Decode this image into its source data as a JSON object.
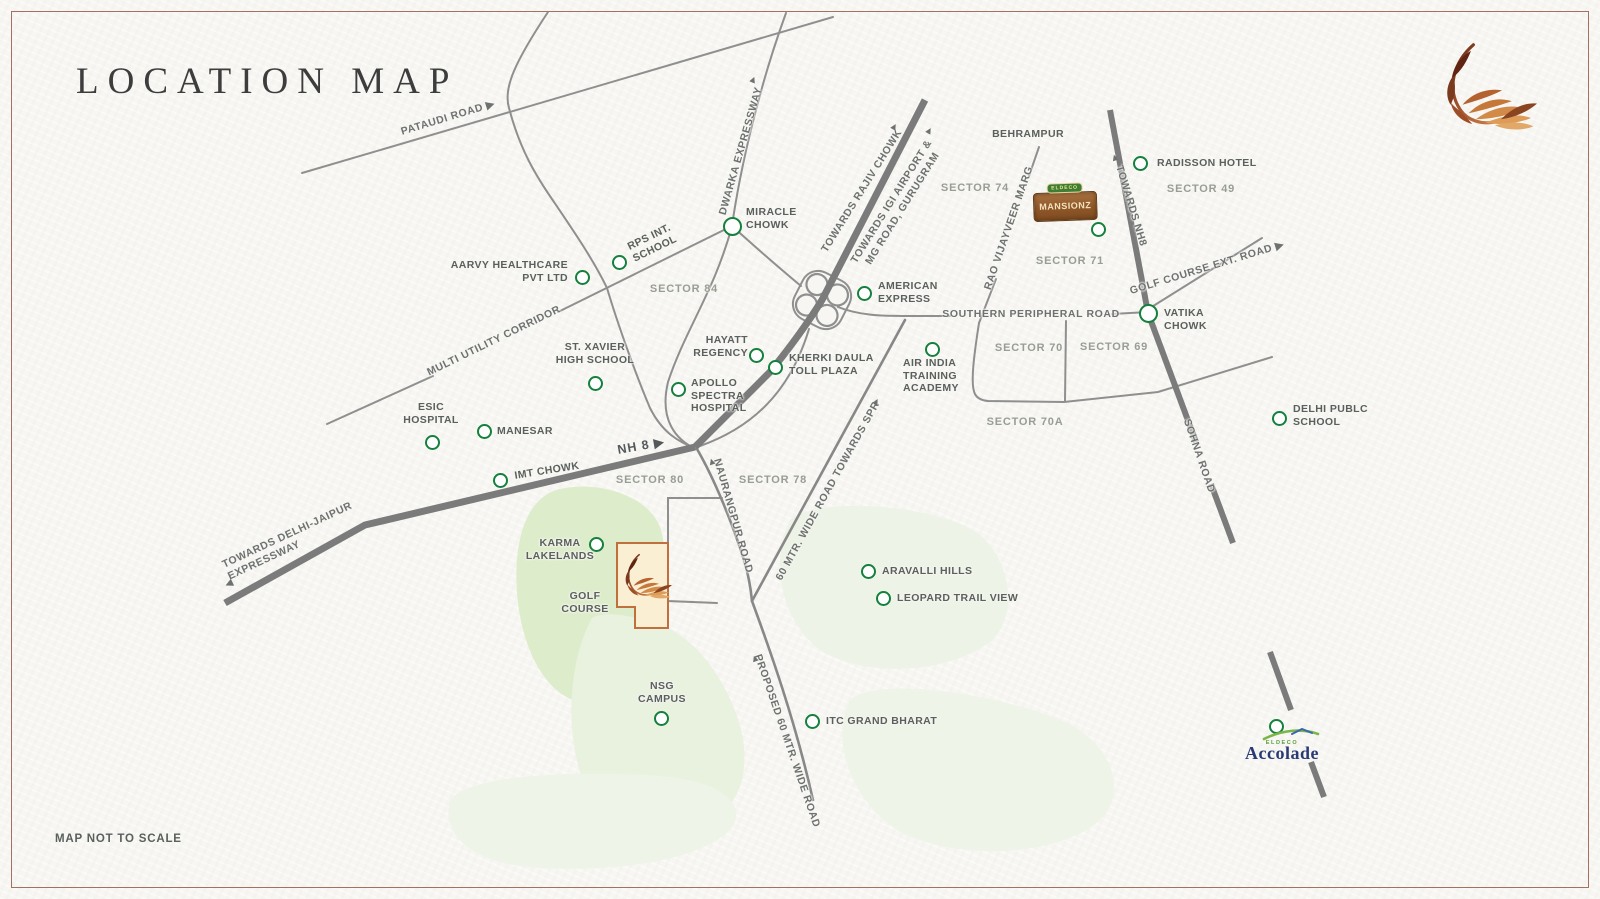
{
  "page": {
    "title": "LOCATION MAP",
    "disclaimer": "MAP NOT TO SCALE"
  },
  "colors": {
    "background": "#f7f6f2",
    "frame_border": "#a4705f",
    "road_thin": "#8f8f8f",
    "road_thick": "#7b7b7b",
    "marker_green": "#15803d",
    "label_dark": "#5a605d",
    "label_sector": "#989d95",
    "golf_green": "#ddecca",
    "pale_green": "#edf3e6",
    "site_fill": "#faeed3",
    "site_border": "#c0703c",
    "feather_copper": "#b4622f",
    "accolade_navy": "#2a3a75",
    "eldeco_green": "#3e7d35"
  },
  "logos": {
    "brand_icon": "feather-icon",
    "mansionz": {
      "badge": "ELDECO",
      "name": "MANSIONZ"
    },
    "accolade": {
      "badge": "ELDECO",
      "name": "Accolade"
    }
  },
  "map": {
    "markers": [
      {
        "id": "miracle-chowk",
        "cx": 732,
        "cy": 226,
        "r": 9.5,
        "lines": [
          "MIRACLE",
          "CHOWK"
        ],
        "anchor": "left",
        "lx": 746,
        "ly": 206
      },
      {
        "id": "rps-int-school",
        "cx": 619,
        "cy": 262,
        "lines": [
          "RPS INT.",
          "SCHOOL"
        ],
        "rot": -26,
        "lx": 652,
        "ly": 243
      },
      {
        "id": "aarvy-healthcare",
        "cx": 582,
        "cy": 277,
        "lines": [
          "AARVY HEALTHCARE",
          "PVT LTD"
        ],
        "anchor": "right",
        "lx": 568,
        "ly": 259
      },
      {
        "id": "american-express",
        "cx": 864,
        "cy": 293,
        "lines": [
          "AMERICAN",
          "EXPRESS"
        ],
        "anchor": "left",
        "lx": 878,
        "ly": 280
      },
      {
        "id": "radisson-hotel",
        "cx": 1140,
        "cy": 163,
        "lines": [
          "RADISSON HOTEL"
        ],
        "anchor": "left",
        "lx": 1157,
        "ly": 157
      },
      {
        "id": "behrampur",
        "lines": [
          "BEHRAMPUR"
        ],
        "anchor": "center",
        "lx": 1028,
        "ly": 128
      },
      {
        "id": "mansionz-site",
        "cx": 1098,
        "cy": 229
      },
      {
        "id": "vatika-chowk",
        "cx": 1148,
        "cy": 313,
        "r": 9.5,
        "lines": [
          "VATIKA",
          "CHOWK"
        ],
        "anchor": "left",
        "lx": 1164,
        "ly": 307
      },
      {
        "id": "hayatt-regency",
        "cx": 756,
        "cy": 355,
        "lines": [
          "HAYATT",
          "REGENCY"
        ],
        "anchor": "right",
        "lx": 748,
        "ly": 334
      },
      {
        "id": "kherki-daula-toll-plaza",
        "cx": 775,
        "cy": 367,
        "lines": [
          "KHERKI DAULA",
          "TOLL PLAZA"
        ],
        "anchor": "left",
        "lx": 789,
        "ly": 352
      },
      {
        "id": "apollo-spectra-hospital",
        "cx": 678,
        "cy": 389,
        "lines": [
          "APOLLO",
          "SPECTRA",
          "HOSPITAL"
        ],
        "anchor": "left",
        "lx": 691,
        "ly": 377
      },
      {
        "id": "st-xavier-high-school",
        "cx": 595,
        "cy": 383,
        "lines": [
          "ST. XAVIER",
          "HIGH SCHOOL"
        ],
        "anchor": "center",
        "lx": 595,
        "ly": 341
      },
      {
        "id": "air-india-training-academy",
        "cx": 932,
        "cy": 349,
        "lines": [
          "AIR INDIA",
          "TRAINING",
          "ACADEMY"
        ],
        "anchor": "left",
        "lx": 903,
        "ly": 357
      },
      {
        "id": "esic-hospital",
        "cx": 432,
        "cy": 442,
        "lines": [
          "ESIC",
          "HOSPITAL"
        ],
        "anchor": "center",
        "lx": 431,
        "ly": 401
      },
      {
        "id": "manesar",
        "cx": 484,
        "cy": 431,
        "lines": [
          "MANESAR"
        ],
        "anchor": "left",
        "lx": 497,
        "ly": 425
      },
      {
        "id": "imt-chowk",
        "cx": 500,
        "cy": 480,
        "lines": [
          "IMT CHOWK"
        ],
        "rot": -9,
        "lx": 547,
        "ly": 471
      },
      {
        "id": "karma-lakelands",
        "cx": 596,
        "cy": 544,
        "lines": [
          "KARMA",
          "LAKELANDS"
        ],
        "anchor": "center",
        "lx": 560,
        "ly": 537
      },
      {
        "id": "golf-course",
        "lines": [
          "GOLF",
          "COURSE"
        ],
        "anchor": "center",
        "lx": 585,
        "ly": 590
      },
      {
        "id": "nsg-campus",
        "cx": 661,
        "cy": 718,
        "lines": [
          "NSG",
          "CAMPUS"
        ],
        "anchor": "center",
        "lx": 662,
        "ly": 680
      },
      {
        "id": "itc-grand-bharat",
        "cx": 812,
        "cy": 721,
        "lines": [
          "ITC GRAND BHARAT"
        ],
        "anchor": "left",
        "lx": 826,
        "ly": 715
      },
      {
        "id": "aravalli-hills",
        "cx": 868,
        "cy": 571,
        "lines": [
          "ARAVALLI HILLS"
        ],
        "anchor": "left",
        "lx": 882,
        "ly": 565
      },
      {
        "id": "leopard-trail-view",
        "cx": 883,
        "cy": 598,
        "lines": [
          "LEOPARD TRAIL VIEW"
        ],
        "anchor": "left",
        "lx": 897,
        "ly": 592
      },
      {
        "id": "delhi-public-school",
        "cx": 1279,
        "cy": 418,
        "lines": [
          "DELHI PUBLC",
          "SCHOOL"
        ],
        "anchor": "left",
        "lx": 1293,
        "ly": 403
      },
      {
        "id": "accolade-site",
        "cx": 1276,
        "cy": 726
      }
    ],
    "sectors": [
      {
        "id": "sector-84",
        "text": "SECTOR 84",
        "x": 684,
        "y": 289
      },
      {
        "id": "sector-74",
        "text": "SECTOR 74",
        "x": 975,
        "y": 188
      },
      {
        "id": "sector-49",
        "text": "SECTOR 49",
        "x": 1201,
        "y": 189
      },
      {
        "id": "sector-71",
        "text": "SECTOR 71",
        "x": 1070,
        "y": 261
      },
      {
        "id": "sector-70",
        "text": "SECTOR 70",
        "x": 1029,
        "y": 348
      },
      {
        "id": "sector-69",
        "text": "SECTOR 69",
        "x": 1114,
        "y": 347
      },
      {
        "id": "sector-70a",
        "text": "SECTOR 70A",
        "x": 1025,
        "y": 422
      },
      {
        "id": "sector-80",
        "text": "SECTOR 80",
        "x": 650,
        "y": 480
      },
      {
        "id": "sector-78",
        "text": "SECTOR 78",
        "x": 773,
        "y": 480
      }
    ],
    "road_labels": [
      {
        "id": "pataudi-road",
        "lines": [
          "PATAUDI ROAD ▶"
        ],
        "x": 448,
        "y": 118,
        "rot": -17
      },
      {
        "id": "dwarka-expressway",
        "lines": [
          "DWARKA EXPRESSWAY"
        ],
        "x": 741,
        "y": 151,
        "rot": -74,
        "arrow": {
          "char": "▲",
          "x": 753,
          "y": 80,
          "rot": 22
        }
      },
      {
        "id": "towards-rajiv-chowk",
        "lines": [
          "TOWARDS RAJIV CHOWK"
        ],
        "x": 862,
        "y": 191,
        "rot": -58,
        "arrow": {
          "char": "▲",
          "x": 894,
          "y": 127,
          "rot": 30
        }
      },
      {
        "id": "towards-igi-airport",
        "lines": [
          "TOWARDS IGI AIRPORT &",
          "MG ROAD, GURUGRAM"
        ],
        "x": 897,
        "y": 205,
        "rot": -58,
        "arrow": {
          "char": "▲",
          "x": 929,
          "y": 131,
          "rot": 30
        }
      },
      {
        "id": "multi-utility-corridor",
        "lines": [
          "MULTI UTILITY CORRIDOR"
        ],
        "x": 494,
        "y": 341,
        "rot": -26
      },
      {
        "id": "nh-8",
        "lines": [
          "NH 8 ▶"
        ],
        "x": 641,
        "y": 446,
        "rot": -10,
        "cls": "dark"
      },
      {
        "id": "towards-delhi-jaipur",
        "lines": [
          "TOWARDS DELHI-JAIPUR",
          "EXPRESSWAY"
        ],
        "x": 290,
        "y": 541,
        "rot": -25,
        "cls": "la",
        "arrow": {
          "char": "◀",
          "x": 229,
          "y": 584,
          "rot": -25
        }
      },
      {
        "id": "naurangpur-road",
        "lines": [
          "NAURANGPUR ROAD"
        ],
        "x": 733,
        "y": 516,
        "rot": 74,
        "arrow": {
          "char": "▲",
          "x": 712,
          "y": 462,
          "rot": -18
        }
      },
      {
        "id": "sixty-mtr-wide-road",
        "lines": [
          "60 MTR. WIDE ROAD TOWARDS SPR"
        ],
        "x": 828,
        "y": 491,
        "rot": -61,
        "arrow": {
          "char": "▲",
          "x": 876,
          "y": 402,
          "rot": 28
        }
      },
      {
        "id": "proposed-sixty-mtr-road",
        "lines": [
          "PROPOSED 60 MTR. WIDE ROAD"
        ],
        "x": 787,
        "y": 741,
        "rot": 71,
        "arrow": {
          "char": "▲",
          "x": 755,
          "y": 659,
          "rot": -20
        }
      },
      {
        "id": "southern-peripheral-road",
        "lines": [
          "SOUTHERN PERIPHERAL ROAD"
        ],
        "x": 1031,
        "y": 314,
        "rot": 0
      },
      {
        "id": "rao-vijayveer-marg",
        "lines": [
          "RAO VIJAYVEER MARG"
        ],
        "x": 1009,
        "y": 228,
        "rot": -71
      },
      {
        "id": "towards-nh8",
        "lines": [
          "TOWARDS NH8"
        ],
        "x": 1131,
        "y": 206,
        "rot": 73,
        "arrow": {
          "char": "▲",
          "x": 1115,
          "y": 158,
          "rot": -18
        }
      },
      {
        "id": "golf-course-ext-road",
        "lines": [
          "GOLF COURSE EXT. ROAD ▶"
        ],
        "x": 1207,
        "y": 268,
        "rot": -17
      },
      {
        "id": "sohna-road",
        "lines": [
          "SOHNA ROAD"
        ],
        "x": 1199,
        "y": 456,
        "rot": 71
      }
    ]
  }
}
